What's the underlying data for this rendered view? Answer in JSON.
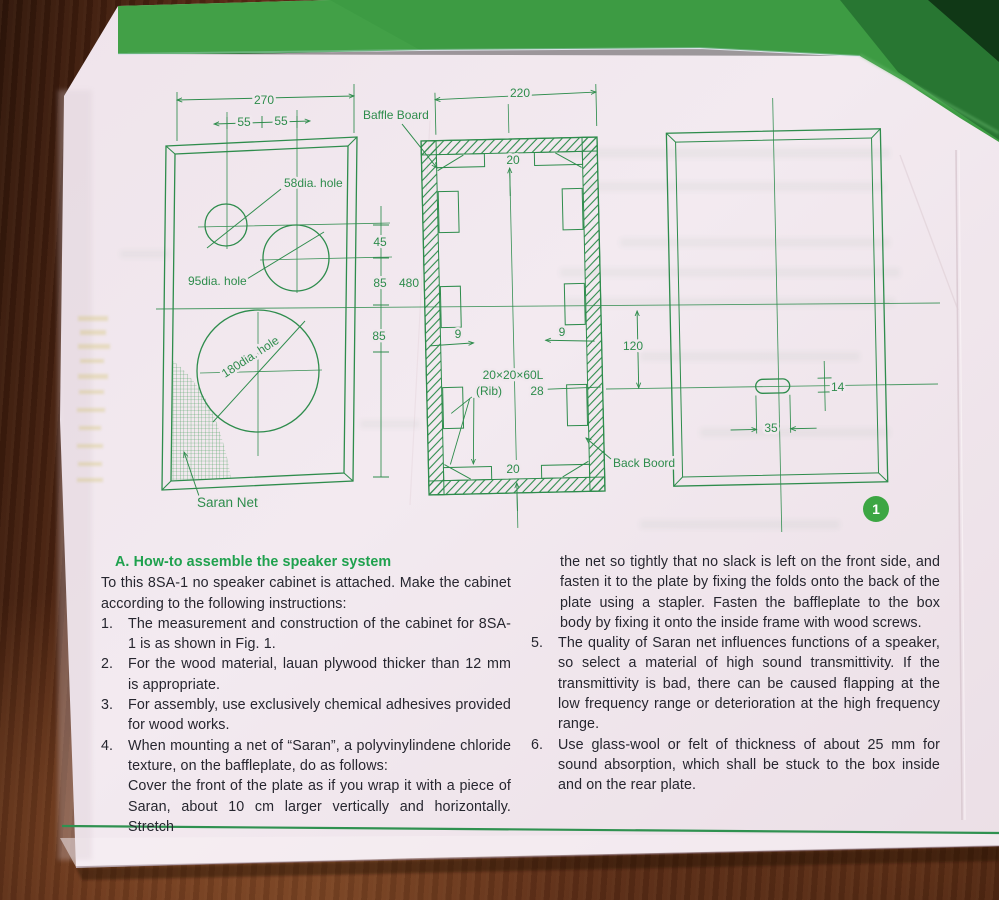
{
  "figure": {
    "labels": {
      "baffle_board": "Baffle Board",
      "back_board": "Back Boord",
      "saran_net": "Saran Net",
      "hole_58": "58dia. hole",
      "hole_95": "95dia. hole",
      "hole_180": "180dia. hole",
      "rib_size": "20×20×60L",
      "rib_label": "(Rib)",
      "rib_length": "28"
    },
    "dims": {
      "front_width": "270",
      "front_pitch_a": "55",
      "front_pitch_b": "55",
      "v_45": "45",
      "v_85a": "85",
      "v_height": "480",
      "v_85b": "85",
      "section_width": "220",
      "top_gap": "20",
      "rib_left": "9",
      "rib_right": "9",
      "bottom_gap": "20",
      "back_offset": "120",
      "slot_width": "35",
      "slot_height": "14"
    },
    "page_badge": "1"
  },
  "instructions": {
    "heading": "A.  How-to assemble the speaker system",
    "intro": "To this 8SA-1 no speaker cabinet is attached.  Make the cabinet according to the following instructions:",
    "left_items": [
      {
        "num": "1.",
        "text": "The measurement and construction of the cabinet for 8SA-1 is as shown in Fig. 1."
      },
      {
        "num": "2.",
        "text": "For the wood material, lauan plywood thicker than 12 mm is appropriate."
      },
      {
        "num": "3.",
        "text": "For assembly, use exclusively chemical adhesives provided for wood works."
      },
      {
        "num": "4.",
        "text": "When mounting a net of “Saran”, a polyvinylindene chloride texture, on the baffleplate, do as follows:",
        "text2": "Cover the front of the plate as if you wrap it with a piece of Saran, about 10 cm larger vertically and horizontally.  Stretch"
      }
    ],
    "right_continuation": "the net so tightly that no slack is left on the front side, and fasten it to the plate by fixing the folds onto the back of the plate using a stapler.  Fasten the baffleplate to the box body by fixing it onto the inside frame with wood screws.",
    "right_items": [
      {
        "num": "5.",
        "text": "The quality of Saran net influences functions of a speaker, so select a material of high sound transmittivity.  If the transmittivity is bad, there can be caused flapping at the low frequency range or deterioration at the high frequency range."
      },
      {
        "num": "6.",
        "text": "Use glass-wool or felt of thickness of about 25 mm for sound absorption, which shall be stuck to the box inside and on the rear plate."
      }
    ]
  },
  "colors": {
    "ink": "#2e8c4c",
    "band_green": "#3d9b43",
    "heading_green": "#1fa14e",
    "badge_green": "#3ca643",
    "paper": "#f1e8ee"
  }
}
